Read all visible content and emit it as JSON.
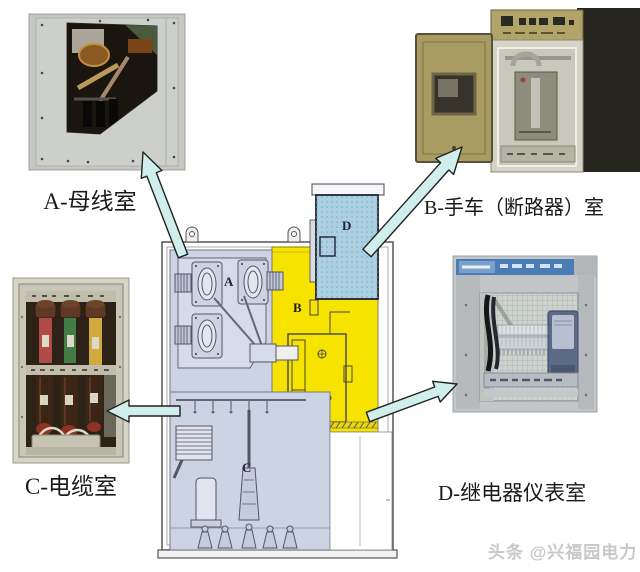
{
  "captions": {
    "a": "A-母线室",
    "b": "B-手车（断路器）室",
    "c": "C-电缆室",
    "d": "D-继电器仪表室"
  },
  "diagram": {
    "letters": {
      "a": "A",
      "b": "B",
      "c": "C",
      "d": "D"
    },
    "colors": {
      "compartment_a": "#ccd3e3",
      "compartment_b": "#f6e300",
      "compartment_c": "#ccd3e3",
      "compartment_d": "#abd0e2",
      "arrow_fill": "#cfeeec",
      "outline": "#555555"
    }
  },
  "watermark": "头条 @兴福园电力"
}
